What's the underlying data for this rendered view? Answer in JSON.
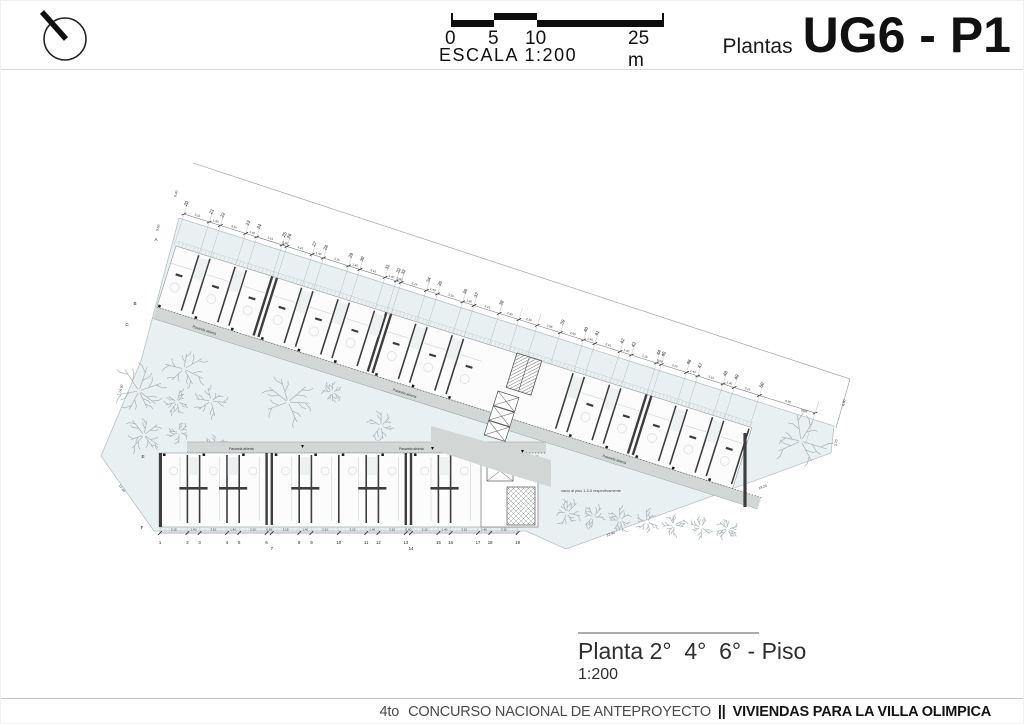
{
  "header": {
    "scale_ticks": [
      "0",
      "5",
      "10",
      "25 m"
    ],
    "scale_label": "ESCALA 1:200",
    "title_prefix": "Plantas",
    "title": "UG6 - P1"
  },
  "plan": {
    "pasarela_label": "Pasarela abierta",
    "note_vacio": "vacío al piso 1-3-5 respectivamente",
    "upper_grid": {
      "numbers": [
        "20",
        "21",
        "22",
        "23",
        "24",
        "25",
        "26",
        "27",
        "28",
        "29",
        "30",
        "31",
        "32",
        "33",
        "34",
        "35",
        "36",
        "37",
        "38",
        "",
        "",
        "39",
        "40",
        "41",
        "42",
        "43",
        "44",
        "45",
        "46",
        "47",
        "48",
        "49",
        "50",
        ""
      ],
      "dims": [
        "3.15",
        "1.40",
        "3.15",
        "1.40",
        "3.15",
        "0.60",
        "3.15",
        "1.40",
        "3.15",
        "1.40",
        "3.15",
        "1.40",
        "0.60",
        "3.15",
        "1.40",
        "3.15",
        "1.40",
        "3.15",
        "2.45",
        "2.30",
        "2.88",
        "2.90",
        "1.40",
        "3.15",
        "1.40",
        "3.15",
        "0.60",
        "3.15",
        "1.40",
        "3.15",
        "1.40",
        "3.15",
        "6.95"
      ]
    },
    "lower_grid": {
      "numbers": [
        "1",
        "2",
        "3",
        "4",
        "5",
        "6",
        "7",
        "8",
        "9",
        "10",
        "11",
        "12",
        "13",
        "14",
        "15",
        "16",
        "17",
        "18",
        "19"
      ],
      "dims": [
        "3.15",
        "1.40",
        "3.15",
        "1.40",
        "3.15",
        "0.60",
        "3.15",
        "1.40",
        "3.15",
        "3.15",
        "1.40",
        "3.15",
        "0.60",
        "3.15",
        "1.40",
        "3.15",
        "1.40",
        "3.15"
      ]
    },
    "row_letters_upper": [
      "A",
      "B",
      "C"
    ],
    "row_letters_lower": [
      "E",
      "F"
    ],
    "misc_dims": {
      "left_top": "6.40",
      "left_mid": "5.50",
      "left_edge": "14.60",
      "left_lower": "17.40",
      "right_top": "4.50",
      "right_upper": "6.95",
      "right_mid": "3.70",
      "right_diag": "19.20",
      "bottom_right": "22.90"
    },
    "colors": {
      "site": "#e9f0f2",
      "boundary": "#b6c2c4",
      "walkway": "#d2d6d5",
      "wall": "#3d3d3d",
      "lightline": "#c3cbcd",
      "tree": "#a6b3b5",
      "dimline": "#6b6b6b",
      "dimtext": "#333333",
      "number": "#1a1a1a"
    },
    "trees": [
      [
        138,
        390,
        26
      ],
      [
        183,
        368,
        21
      ],
      [
        176,
        401,
        12
      ],
      [
        210,
        400,
        15
      ],
      [
        143,
        434,
        19
      ],
      [
        178,
        431,
        12
      ],
      [
        213,
        444,
        11
      ],
      [
        287,
        401,
        27
      ],
      [
        331,
        391,
        10
      ],
      [
        380,
        425,
        13
      ],
      [
        566,
        512,
        13
      ],
      [
        592,
        516,
        12
      ],
      [
        619,
        519,
        12
      ],
      [
        646,
        521,
        12
      ],
      [
        673,
        524,
        12
      ],
      [
        700,
        526,
        11
      ],
      [
        727,
        528,
        11
      ],
      [
        800,
        440,
        26
      ]
    ]
  },
  "caption": {
    "title": "Planta 2°  4°  6° - Piso",
    "scale": "1:200"
  },
  "footer": {
    "prefix_num": "4",
    "prefix_sup": "to",
    "part1": "CONCURSO NACIONAL DE ANTEPROYECTO",
    "sep": "||",
    "part2": "VIVIENDAS PARA LA VILLA OLIMPICA"
  }
}
